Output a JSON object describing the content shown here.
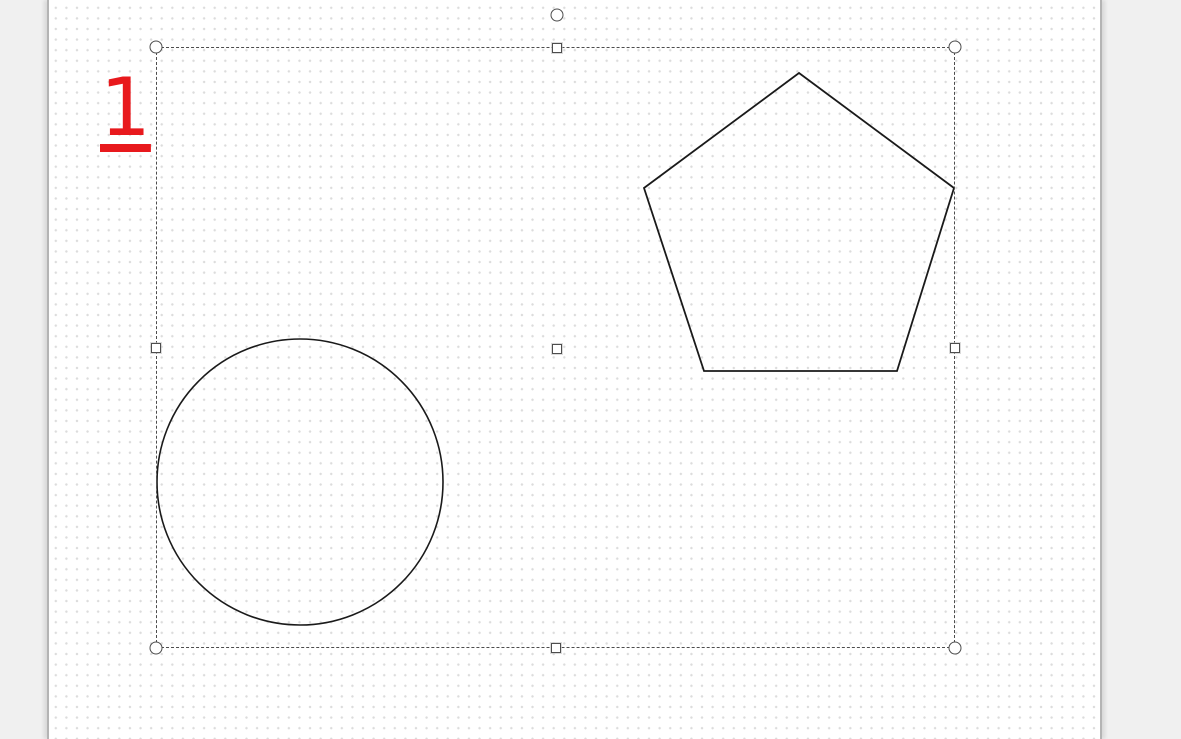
{
  "app": {
    "type": "drawing-canvas",
    "background_color": "#f0f0f0"
  },
  "page": {
    "background_color": "#ffffff",
    "grid_dot_color": "#dcdcdc",
    "grid_spacing_px": 10.6,
    "left_px": 47,
    "width_px": 1055
  },
  "annotation": {
    "text": "1",
    "color": "#e8191d",
    "underlined": true
  },
  "shapes": [
    {
      "id": "circle-shape",
      "type": "circle",
      "cx": 300,
      "cy": 482,
      "r": 143,
      "stroke": "#1a1a1a",
      "stroke_width": 1.6,
      "fill": "none"
    },
    {
      "id": "pentagon-shape",
      "type": "polygon",
      "points": [
        [
          799,
          73
        ],
        [
          954,
          188
        ],
        [
          897,
          371
        ],
        [
          704,
          371
        ],
        [
          644,
          188
        ]
      ],
      "stroke": "#1a1a1a",
      "stroke_width": 1.8,
      "fill": "none"
    }
  ],
  "selection": {
    "rect": {
      "x": 156,
      "y": 47,
      "width": 799,
      "height": 601
    },
    "border_color": "#4d4d4d",
    "handle_fill": "#ffffff",
    "handles": [
      {
        "id": "rotate-handle",
        "shape": "circle",
        "x": 557,
        "y": 15
      },
      {
        "id": "handle-top-left",
        "shape": "circle",
        "x": 156,
        "y": 47
      },
      {
        "id": "handle-top-middle",
        "shape": "square",
        "x": 557,
        "y": 48
      },
      {
        "id": "handle-top-right",
        "shape": "circle",
        "x": 955,
        "y": 47
      },
      {
        "id": "handle-middle-left",
        "shape": "square",
        "x": 156,
        "y": 348
      },
      {
        "id": "handle-center",
        "shape": "square",
        "x": 557,
        "y": 349
      },
      {
        "id": "handle-middle-right",
        "shape": "square",
        "x": 955,
        "y": 348
      },
      {
        "id": "handle-bottom-left",
        "shape": "circle",
        "x": 156,
        "y": 648
      },
      {
        "id": "handle-bottom-middle",
        "shape": "square",
        "x": 556,
        "y": 648
      },
      {
        "id": "handle-bottom-right",
        "shape": "circle",
        "x": 955,
        "y": 648
      }
    ]
  }
}
